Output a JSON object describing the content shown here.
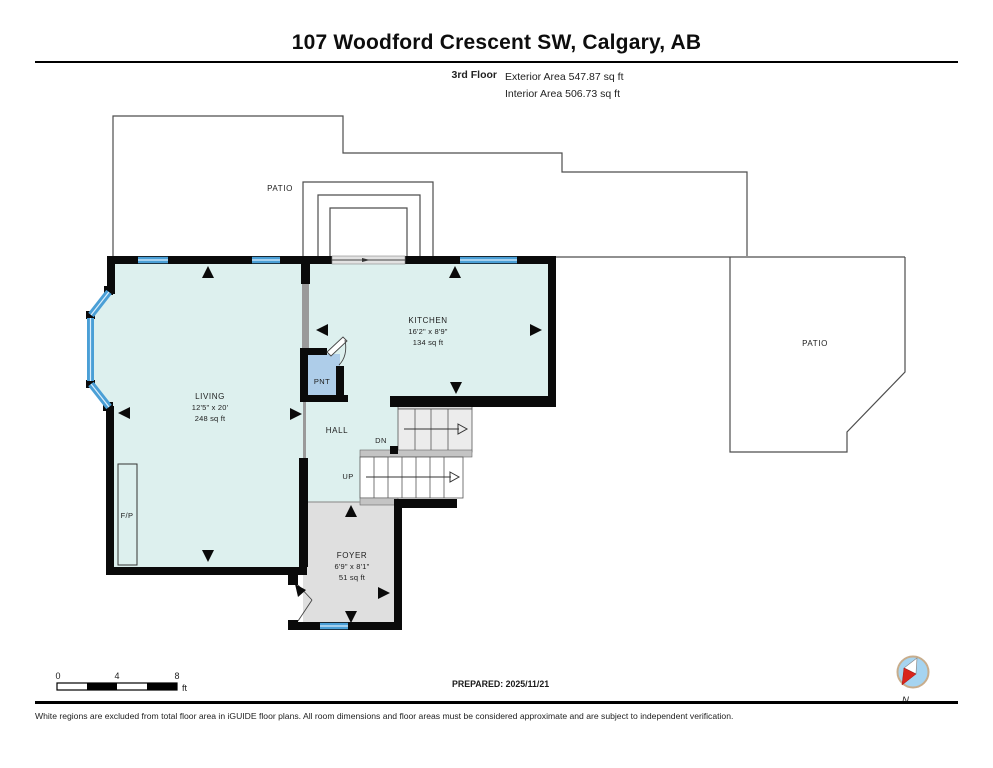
{
  "header": {
    "title": "107 Woodford Crescent SW, Calgary, AB",
    "floor_label": "3rd Floor",
    "exterior_area": "Exterior Area 547.87 sq ft",
    "interior_area": "Interior Area 506.73 sq ft"
  },
  "plan": {
    "rooms": {
      "living": {
        "name": "LIVING",
        "dims": "12'5\" x 20'",
        "area": "248 sq ft"
      },
      "kitchen": {
        "name": "KITCHEN",
        "dims": "16'2\" x 8'9\"",
        "area": "134 sq ft"
      },
      "foyer": {
        "name": "FOYER",
        "dims": "6'9\" x 8'1\"",
        "area": "51 sq ft"
      },
      "hall": {
        "name": "HALL"
      },
      "pantry": {
        "name": "PNT"
      },
      "fireplace": {
        "name": "F/P"
      },
      "patio_left": {
        "name": "PATIO"
      },
      "patio_right": {
        "name": "PATIO"
      },
      "stairs": {
        "up": "UP",
        "down": "DN"
      }
    },
    "colors": {
      "room_fill": "#ddf0ee",
      "pantry_fill": "#aecde9",
      "foyer_fill": "#dfdfdf",
      "window_blue": "#4a9fd6",
      "wall": "#0a0a0a",
      "outline": "#4d4d4d"
    }
  },
  "footer": {
    "scale": {
      "tick0": "0",
      "tick4": "4",
      "tick8": "8",
      "unit": "ft"
    },
    "prepared": "PREPARED: 2025/11/21",
    "compass_label": "N",
    "disclaimer": "White regions are excluded from total floor area in iGUIDE floor plans. All room dimensions and floor areas must be considered approximate and are subject to independent verification."
  }
}
